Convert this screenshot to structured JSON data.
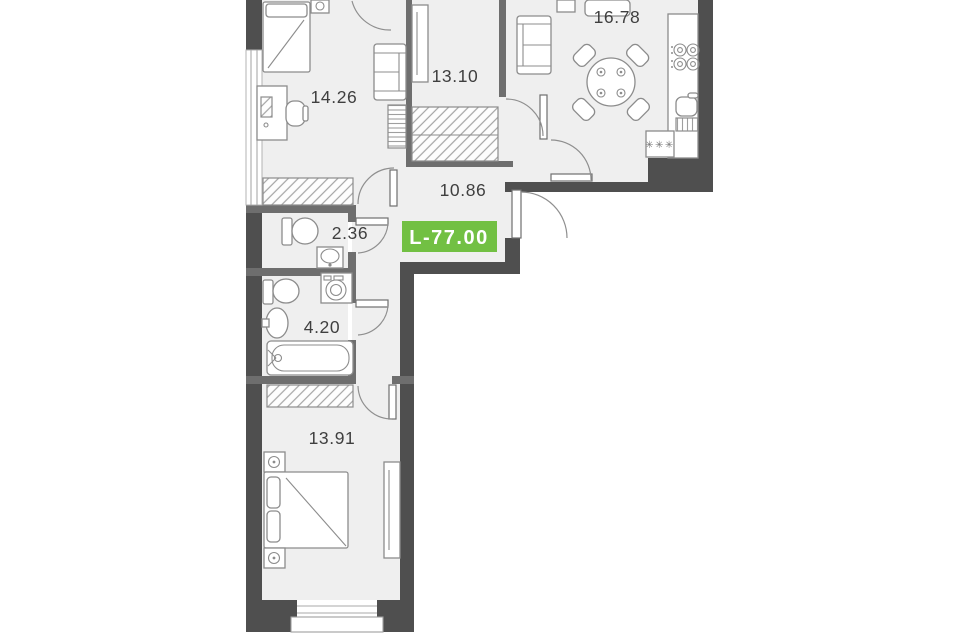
{
  "badge": {
    "label": "L-77.00"
  },
  "rooms": [
    {
      "id": "kitchen-living",
      "area": "16.78"
    },
    {
      "id": "room-13-10",
      "area": "13.10"
    },
    {
      "id": "bedroom-14-26",
      "area": "14.26"
    },
    {
      "id": "hallway",
      "area": "10.86"
    },
    {
      "id": "wc",
      "area": "2.36"
    },
    {
      "id": "bathroom",
      "area": "4.20"
    },
    {
      "id": "bedroom-13-91",
      "area": "13.91"
    }
  ],
  "symbols": {
    "washer": "✳✳✳"
  },
  "colors": {
    "bg": "#ffffff",
    "wall": "#4f4f4f",
    "wall_int": "#6e6e6e",
    "floor": "#efefef",
    "line": "#8c8c8c",
    "line_soft": "#a9a9a9",
    "text": "#3f3f3f",
    "badge_bg": "#72c043",
    "badge_text": "#ffffff"
  }
}
